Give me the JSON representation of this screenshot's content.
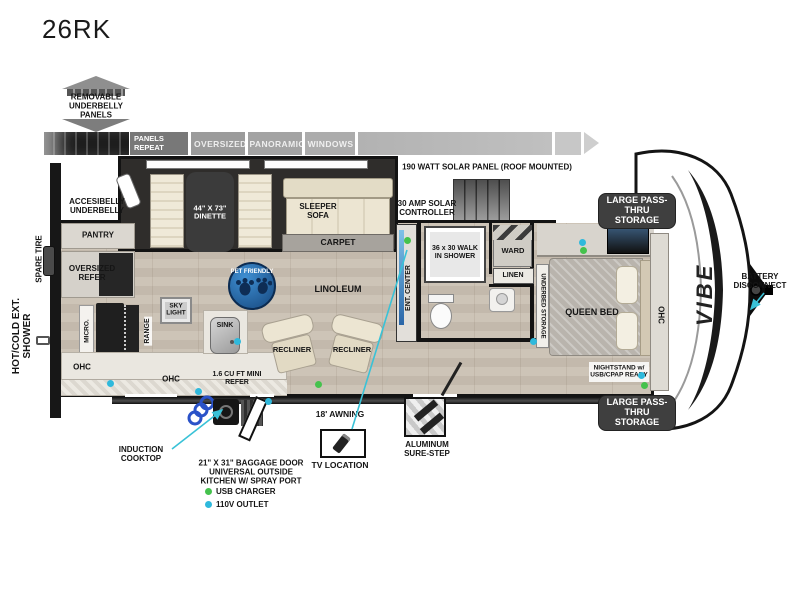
{
  "title": "26RK",
  "colors": {
    "usb_green": "#45c24d",
    "outlet_blue": "#2fb9dc",
    "callout_cyan": "#39c2d7",
    "pet_badge_blue": "#1f5f9e",
    "storage_badge_gray": "#3f3f3f"
  },
  "underbelly": {
    "removable": "REMOVABLE UNDERBELLY PANELS",
    "panels_repeat": "PANELS REPEAT",
    "panoramic": "OVERSIZED PANORAMIC WINDOWS",
    "accessible": "ACCESIBELLY UNDERBELLY"
  },
  "roof": {
    "solar_panel": "190 WATT SOLAR PANEL (ROOF MOUNTED)",
    "controller": "30 AMP SOLAR CONTROLLER"
  },
  "rooms": {
    "dinette": "44\" X 73\" DINETTE",
    "sleeper_sofa": "SLEEPER SOFA",
    "carpet": "CARPET",
    "linoleum": "LINOLEUM",
    "pet_friendly": "PET FRIENDLY",
    "pantry": "PANTRY",
    "oversized_refer": "OVERSIZED REFER",
    "micro": "MICRO.",
    "range": "RANGE",
    "sky_light": "SKY LIGHT",
    "sink": "SINK",
    "ohc": "OHC",
    "mini_refer": "1.6 CU FT MINI REFER",
    "recliner": "RECLINER",
    "ent_center": "ENT. CENTER",
    "shower": "36 x 30 WALK IN SHOWER",
    "ward": "WARD",
    "linen": "LINEN",
    "underbed": "UNDERBED STORAGE",
    "queen_bed": "QUEEN BED",
    "nightstand": "NIGHTSTAND w/ USB/CPAP READY"
  },
  "exterior": {
    "spare_tire": "SPARE TIRE",
    "ext_shower": "HOT/COLD EXT. SHOWER",
    "pass_thru": "LARGE PASS-THRU STORAGE",
    "battery": "BATTERY DISCONNECT",
    "brand": "VIBE",
    "induction": "INDUCTION COOKTOP",
    "baggage_door": "21\" X 31\" BAGGAGE DOOR UNIVERSAL OUTSIDE KITCHEN W/ SPRAY PORT",
    "awning": "18' AWNING",
    "tv_location": "TV LOCATION",
    "sure_step": "ALUMINUM SURE-STEP"
  },
  "legend": {
    "usb": "USB CHARGER",
    "outlet": "110V OUTLET"
  }
}
